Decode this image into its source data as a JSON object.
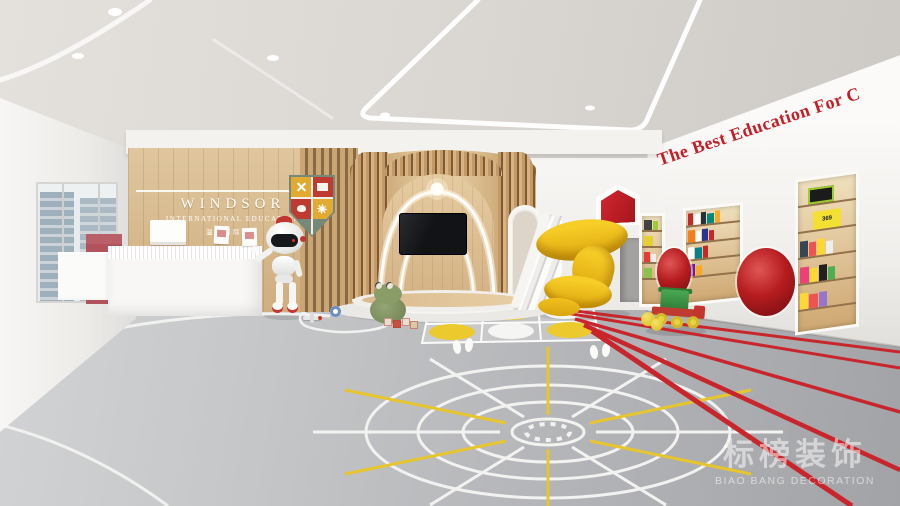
{
  "branding": {
    "name": "WINDSOR",
    "subtitle": "INTERNATIONAL EDUCATION",
    "chinese": "温莎国际教育"
  },
  "right_wall": {
    "slogan": "The Best Education For C"
  },
  "shelf": {
    "book_numbers": "369"
  },
  "watermark": {
    "chinese": "标榜装饰",
    "english": "BIAO BANG DECORATION"
  },
  "colors": {
    "accent_red": "#c41e28",
    "pod_red": "#b01218",
    "track_red": "#c8262c",
    "wood_light": "#e5caa0",
    "wood_dark": "#96713f",
    "slide_yellow": "#f2c21e",
    "floor_gray": "#b9babc",
    "marking_yellow": "#e6c52f",
    "marking_white": "#f2f2f2"
  }
}
